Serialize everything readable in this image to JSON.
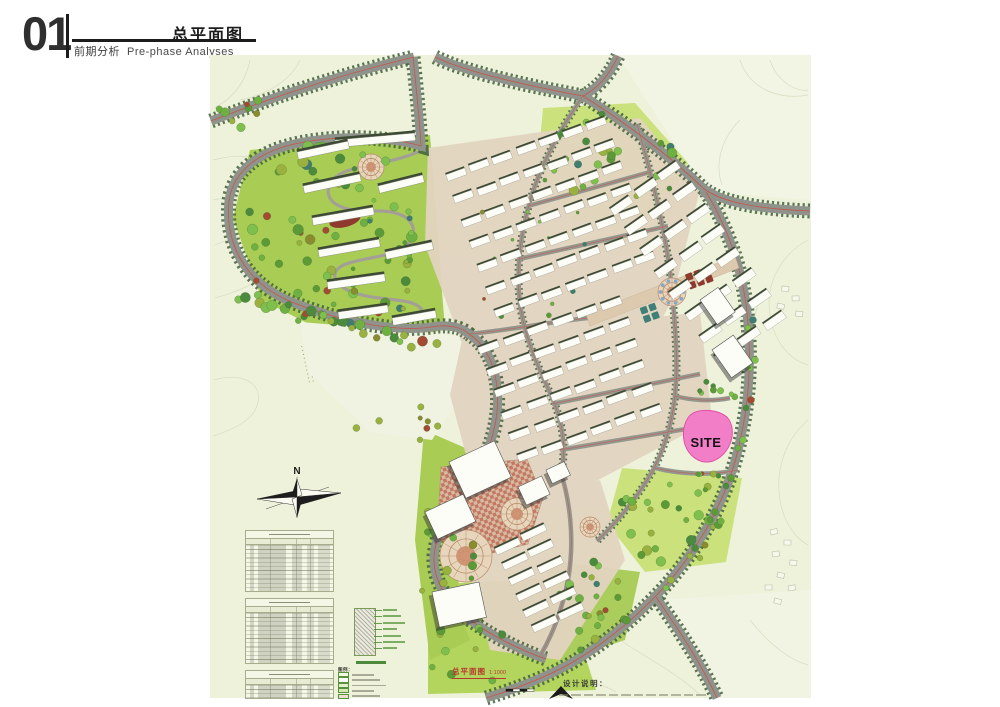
{
  "header": {
    "index": "01",
    "title": "总平面图",
    "subtitle_cn": "前期分析",
    "subtitle_en": "Pre-phase Analyses"
  },
  "map": {
    "site_label": "SITE",
    "compass_label": "N",
    "caption": {
      "title": "总平面图",
      "scale": "1:1000"
    },
    "notes": {
      "title": "设计说明："
    },
    "legend": {
      "title": "图例：",
      "item_count": 5
    },
    "indicator_tables": {
      "section_count": 3
    }
  },
  "colors": {
    "offsite": "#eef2db",
    "contour": "#d8dcc0",
    "road": "#8f938c",
    "road_centerline": "#c4574a",
    "road_trees": "#41603c",
    "ground": "#e2d4c0",
    "lawn": "#b3d55e",
    "park": "#cbe17c",
    "plaza_checker_a": "#d7b9a4",
    "plaza_checker_b": "#c3795f",
    "building_white": "#fdfdf8",
    "building_shade": "#3d4a33",
    "site_pink": "#f27ec7",
    "site_stroke": "#de4da6",
    "caption_red": "#b5392b"
  }
}
